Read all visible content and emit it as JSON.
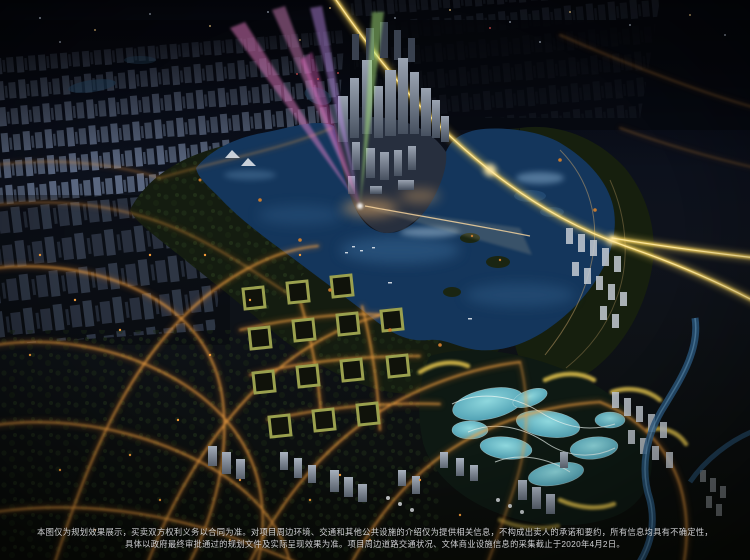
{
  "scene": {
    "type": "aerial-night-planning-render",
    "disclaimer": {
      "line1": "本图仅为规划效果展示，买卖双方权利义务以合同为准。对项目周边环境、交通和其他公共设施的介绍仅为提供相关信息，不构成出卖人的承诺和要约，所有信息均具有不确定性，",
      "line2": "具体以政府最终审批通过的规划文件及实际呈现效果为准。项目周边道路交通状况、文体商业设施信息的采集截止于2020年4月2日。"
    },
    "palette": {
      "sky_top": "#04050a",
      "ground": "#0b0e09",
      "water_deep": "#0e2746",
      "water_light": "#2e6294",
      "park_green": "#15200f",
      "wetland_pool": "#79ccd6",
      "road_glow": "#e8862f",
      "road_bright": "#f5a545",
      "highway": "#ffd95e",
      "highway_core": "#ffe9a0",
      "beam_pink": "#ff8ad8",
      "beam_violet": "#c490f0",
      "beam_green": "#a9e87c",
      "beam_warm": "#ffe9b0",
      "courtyard_roof": "#9aa04e",
      "wetland_building": "#d7b948",
      "white_cluster": "#c3cad3",
      "light_dot": "#f59d3a",
      "river": "#2c5d86"
    }
  }
}
